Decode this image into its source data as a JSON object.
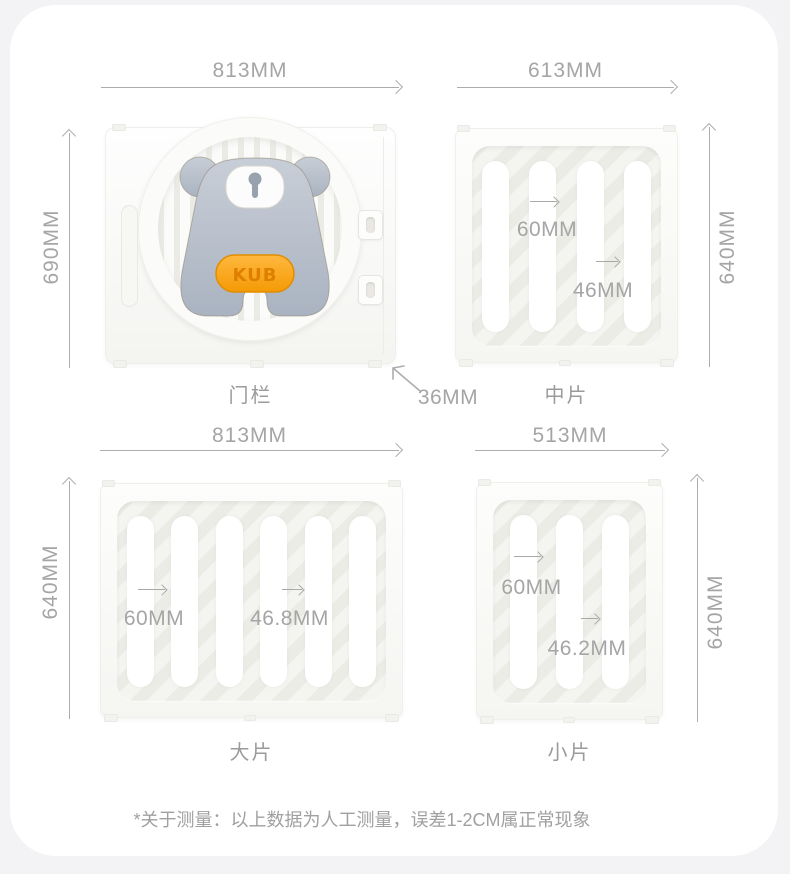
{
  "parts": {
    "door": {
      "label": "门栏",
      "width": "813MM",
      "height": "690MM",
      "thickness": "36MM",
      "badge": "KUB"
    },
    "middle": {
      "label": "中片",
      "width": "613MM",
      "height": "640MM",
      "slot_pitch": "60MM",
      "slot_gap": "46MM"
    },
    "large": {
      "label": "大片",
      "width": "813MM",
      "height": "640MM",
      "slot_pitch": "60MM",
      "slot_gap": "46.8MM"
    },
    "small": {
      "label": "小片",
      "width": "513MM",
      "height": "640MM",
      "slot_pitch": "60MM",
      "slot_gap": "46.2MM"
    }
  },
  "footnote": "*关于测量：以上数据为人工测量，误差1-2CM属正常现象",
  "colors": {
    "page_background": "#f3f3f5",
    "card_background": "#ffffff",
    "dimension_line": "#adadad",
    "dimension_text": "#a5a5a5",
    "part_label_text": "#9b9b9b",
    "panel_face": "#f5f5f2",
    "slot_fill": "#ffffff",
    "bear_body": "#b9c1cc",
    "bear_muzzle": "#fcfcfc",
    "badge_orange": "#f9a416",
    "badge_text_orange": "#e07f00"
  }
}
